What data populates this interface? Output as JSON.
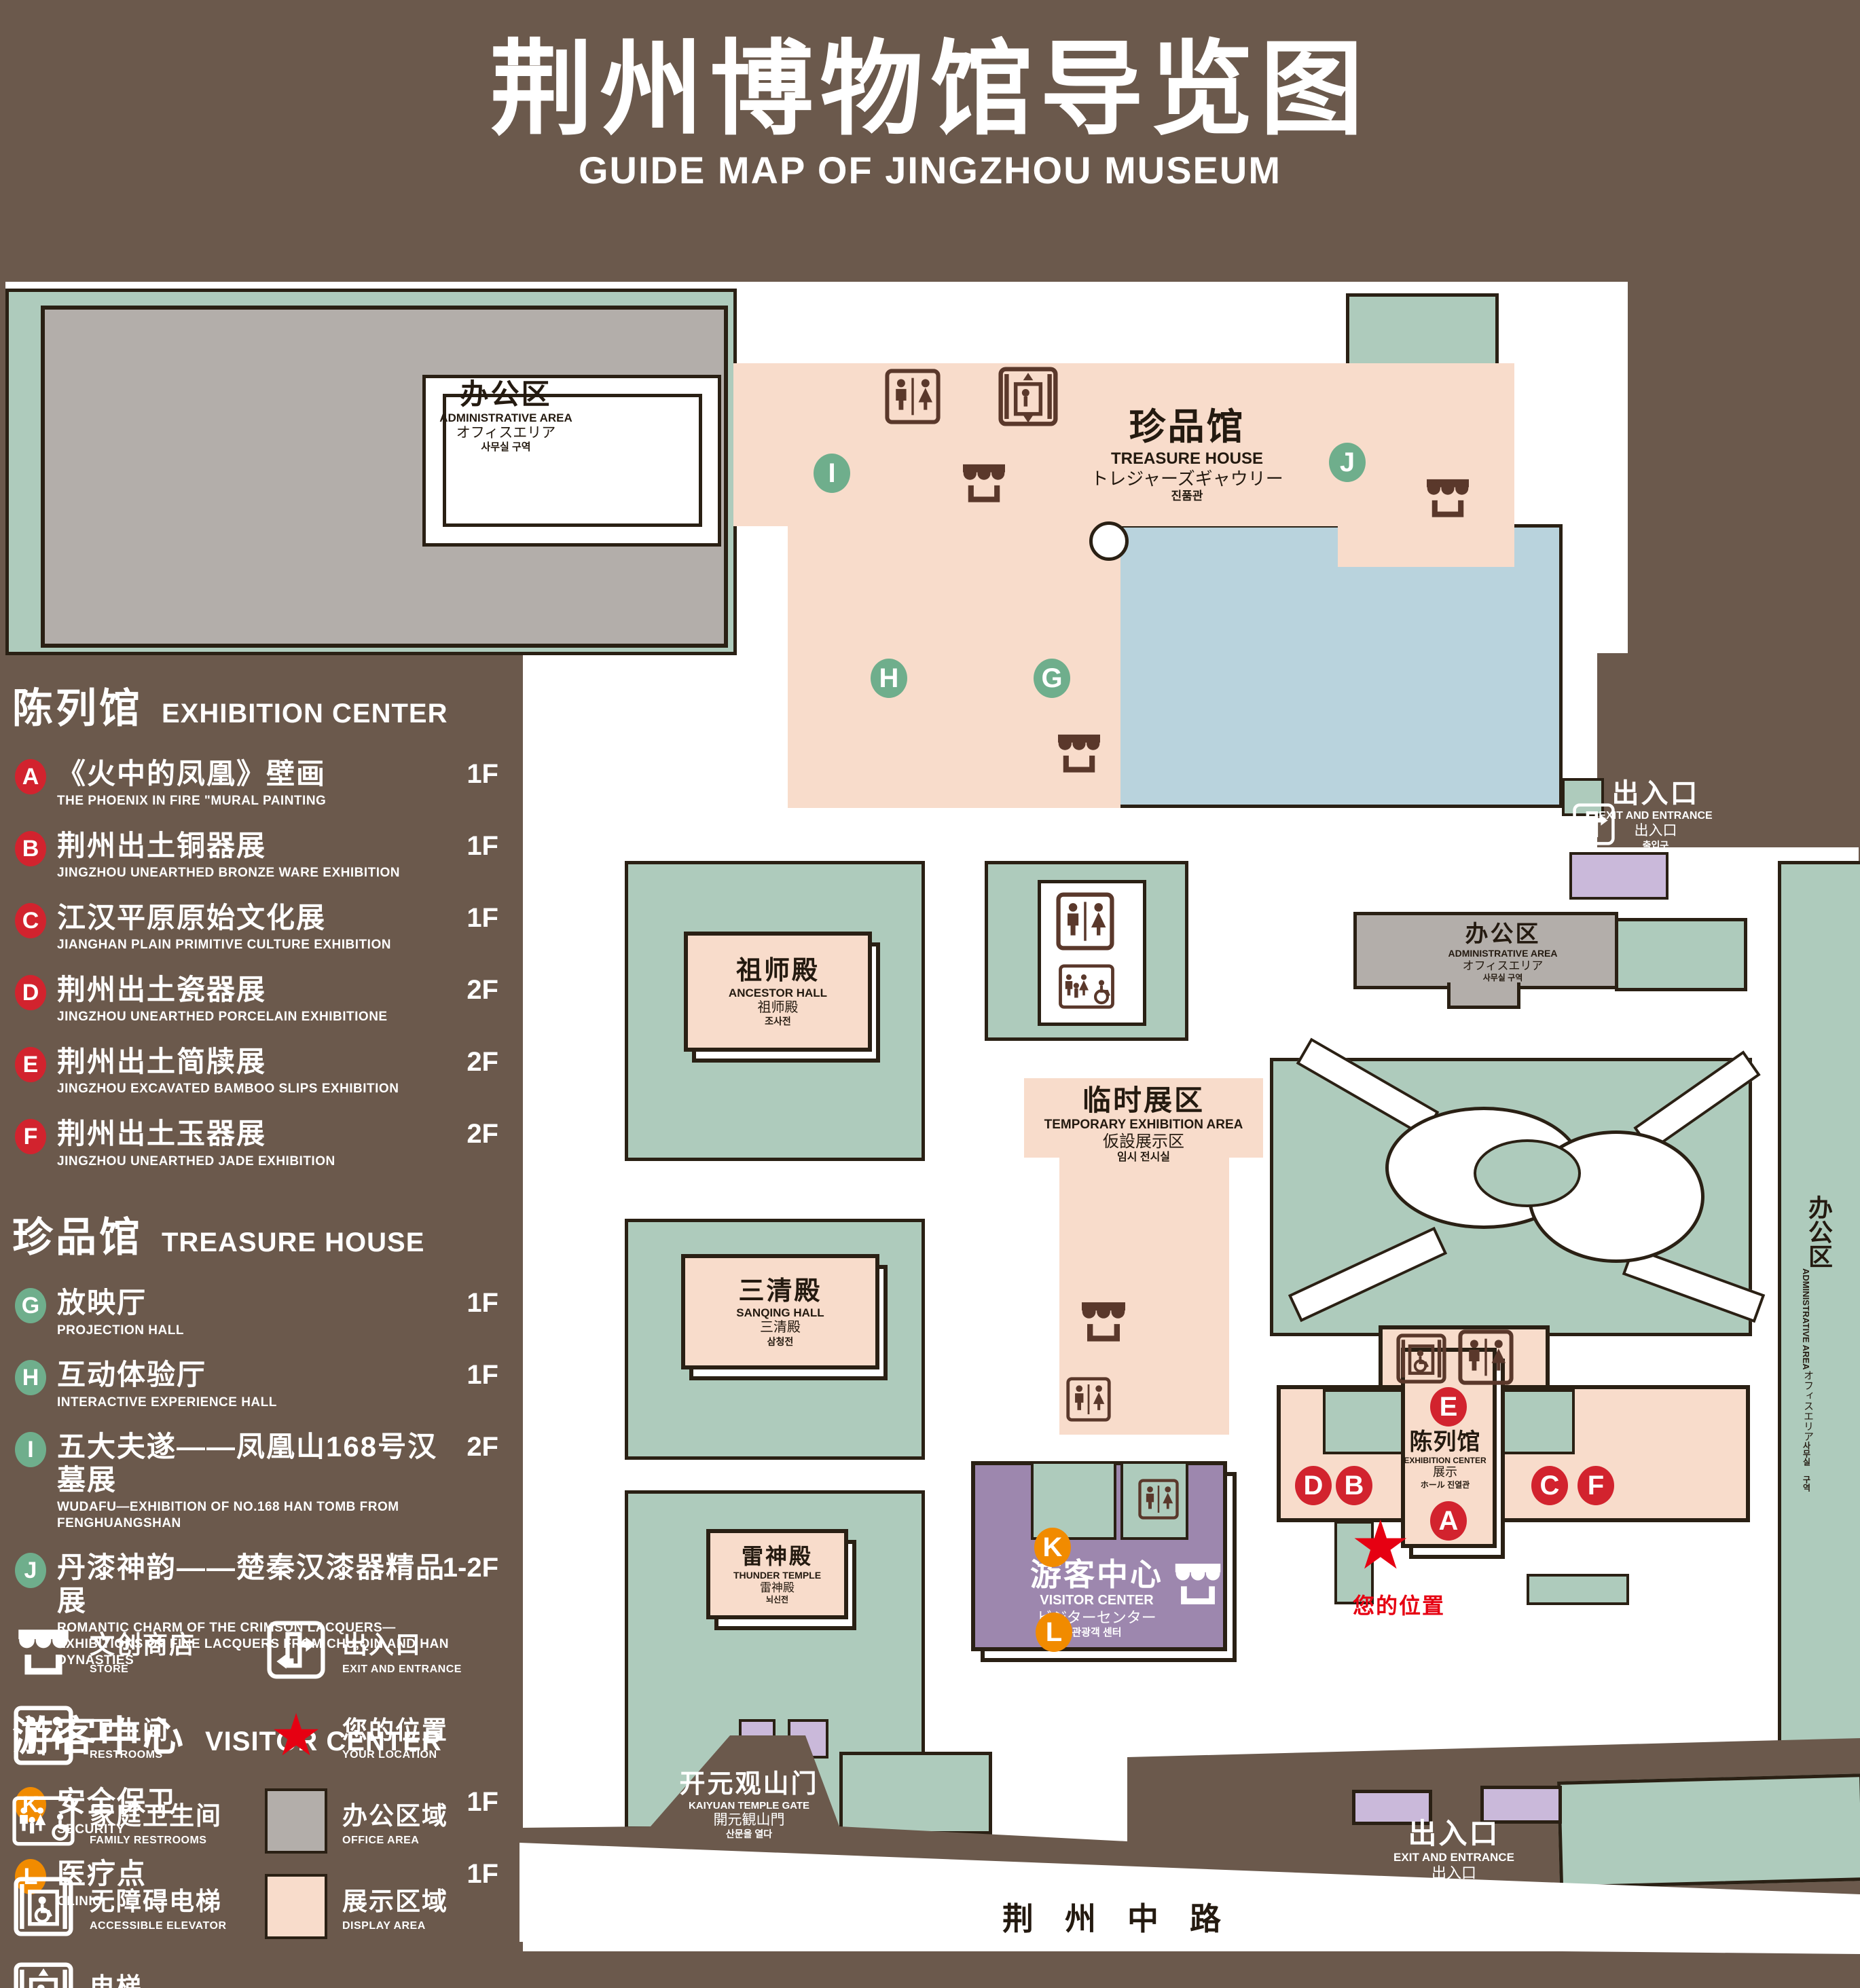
{
  "title": {
    "zh": "荆州博物馆导览图",
    "en": "GUIDE MAP OF JINGZHOU MUSEUM"
  },
  "legend": {
    "sections": [
      {
        "title_zh": "陈列馆",
        "title_en": "EXHIBITION CENTER",
        "items": [
          {
            "id": "A",
            "zh": "《火中的凤凰》壁画",
            "en": "THE PHOENIX IN FIRE \"MURAL PAINTING",
            "floor": "1F"
          },
          {
            "id": "B",
            "zh": "荆州出土铜器展",
            "en": "JINGZHOU UNEARTHED BRONZE WARE EXHIBITION",
            "floor": "1F"
          },
          {
            "id": "C",
            "zh": "江汉平原原始文化展",
            "en": "JIANGHAN PLAIN PRIMITIVE CULTURE EXHIBITION",
            "floor": "1F"
          },
          {
            "id": "D",
            "zh": "荆州出土瓷器展",
            "en": "JINGZHOU UNEARTHED PORCELAIN EXHIBITIONE",
            "floor": "2F"
          },
          {
            "id": "E",
            "zh": "荆州出土简牍展",
            "en": "JINGZHOU EXCAVATED BAMBOO SLIPS EXHIBITION",
            "floor": "2F"
          },
          {
            "id": "F",
            "zh": "荆州出土玉器展",
            "en": "JINGZHOU UNEARTHED JADE EXHIBITION",
            "floor": "2F"
          }
        ]
      },
      {
        "title_zh": "珍品馆",
        "title_en": "TREASURE HOUSE",
        "items": [
          {
            "id": "G",
            "zh": "放映厅",
            "en": "PROJECTION HALL",
            "floor": "1F"
          },
          {
            "id": "H",
            "zh": "互动体验厅",
            "en": "INTERACTIVE EXPERIENCE HALL",
            "floor": "1F"
          },
          {
            "id": "I",
            "zh": "五大夫遂——凤凰山168号汉墓展",
            "en": "WUDAFU—EXHIBITION OF NO.168 HAN TOMB FROM FENGHUANGSHAN",
            "floor": "2F"
          },
          {
            "id": "J",
            "zh": "丹漆神韵——楚秦汉漆器精品展",
            "en": "ROMANTIC CHARM OF THE CRIMSON LACQUERS—EXHIBITIONS OF FINE LACQUERS FROM CHU,QIN AND HAN DYNASTIES",
            "floor": "1-2F"
          }
        ]
      },
      {
        "title_zh": "游客中心",
        "title_en": "VISITOR CENTER",
        "items": [
          {
            "id": "K",
            "zh": "安全保卫",
            "en": "SECURITY",
            "floor": "1F"
          },
          {
            "id": "L",
            "zh": "医疗点",
            "en": "CLINIC",
            "floor": "1F"
          }
        ]
      }
    ],
    "symbols": {
      "store": {
        "zh": "文创商店",
        "en": "STORE"
      },
      "exit": {
        "zh": "出入口",
        "en": "EXIT AND ENTRANCE"
      },
      "restrooms": {
        "zh": "卫生间",
        "en": "RESTROOMS"
      },
      "location": {
        "zh": "您的位置",
        "en": "YOUR LOCATION"
      },
      "family": {
        "zh": "家庭卫生间",
        "en": "FAMILY RESTROOMS"
      },
      "office": {
        "zh": "办公区域",
        "en": "OFFICE AREA"
      },
      "accessible": {
        "zh": "无障碍电梯",
        "en": "ACCESSIBLE ELEVATOR"
      },
      "display": {
        "zh": "展示区域",
        "en": "DISPLAY AREA"
      },
      "elevator": {
        "zh": "电梯",
        "en": "Elevator"
      }
    }
  },
  "map": {
    "buildings": {
      "admin": {
        "zh": "办公区",
        "en": "ADMINISTRATIVE AREA",
        "ja": "オフィスエリア",
        "ko": "사무실 구역"
      },
      "treasure": {
        "zh": "珍品馆",
        "en": "TREASURE HOUSE",
        "ja": "トレジャーズギャウリー",
        "ko": "진품관"
      },
      "ancestor": {
        "zh": "祖师殿",
        "en": "ANCESTOR HALL",
        "ja": "祖师殿",
        "ko": "조사전"
      },
      "temporary": {
        "zh": "临时展区",
        "en": "TEMPORARY EXHIBITION AREA",
        "ja": "仮設展示区",
        "ko": "임시 전시실"
      },
      "sanqing": {
        "zh": "三清殿",
        "en": "SANQING HALL",
        "ja": "三清殿",
        "ko": "삼청전"
      },
      "thunder": {
        "zh": "雷神殿",
        "en": "THUNDER TEMPLE",
        "ja": "雷神殿",
        "ko": "뇌신전"
      },
      "visitor": {
        "zh": "游客中心",
        "en": "VISITOR CENTER",
        "ja": "ビジターセンター",
        "ko": "관광객 센터"
      },
      "exhibition": {
        "zh": "陈列馆",
        "en": "EXHIBITION CENTER",
        "ja": "展示",
        "ko": "ホール 진열관"
      },
      "gate": {
        "zh": "开元观山门",
        "en": "KAIYUAN TEMPLE GATE",
        "ja": "開元観山門",
        "ko": "산문을 열다"
      },
      "exit": {
        "zh": "出入口",
        "en": "EXIT AND ENTRANCE",
        "ja": "出入口",
        "ko": "출입구"
      },
      "road": {
        "zh": "荆州中路"
      }
    },
    "your_location": "您的位置"
  },
  "colors": {
    "background": "#6b594c",
    "lawn": "#aecbbc",
    "display_area": "#f8dccb",
    "office_area": "#b3aeaa",
    "lake": "#b9d3dd",
    "visitor_center": "#9d87ae",
    "gates": "#cab9da",
    "marker_red": "#d2232e",
    "marker_green": "#6fae8c",
    "marker_orange": "#f18b00",
    "star_red": "#e60012",
    "outline": "#2a2014"
  }
}
